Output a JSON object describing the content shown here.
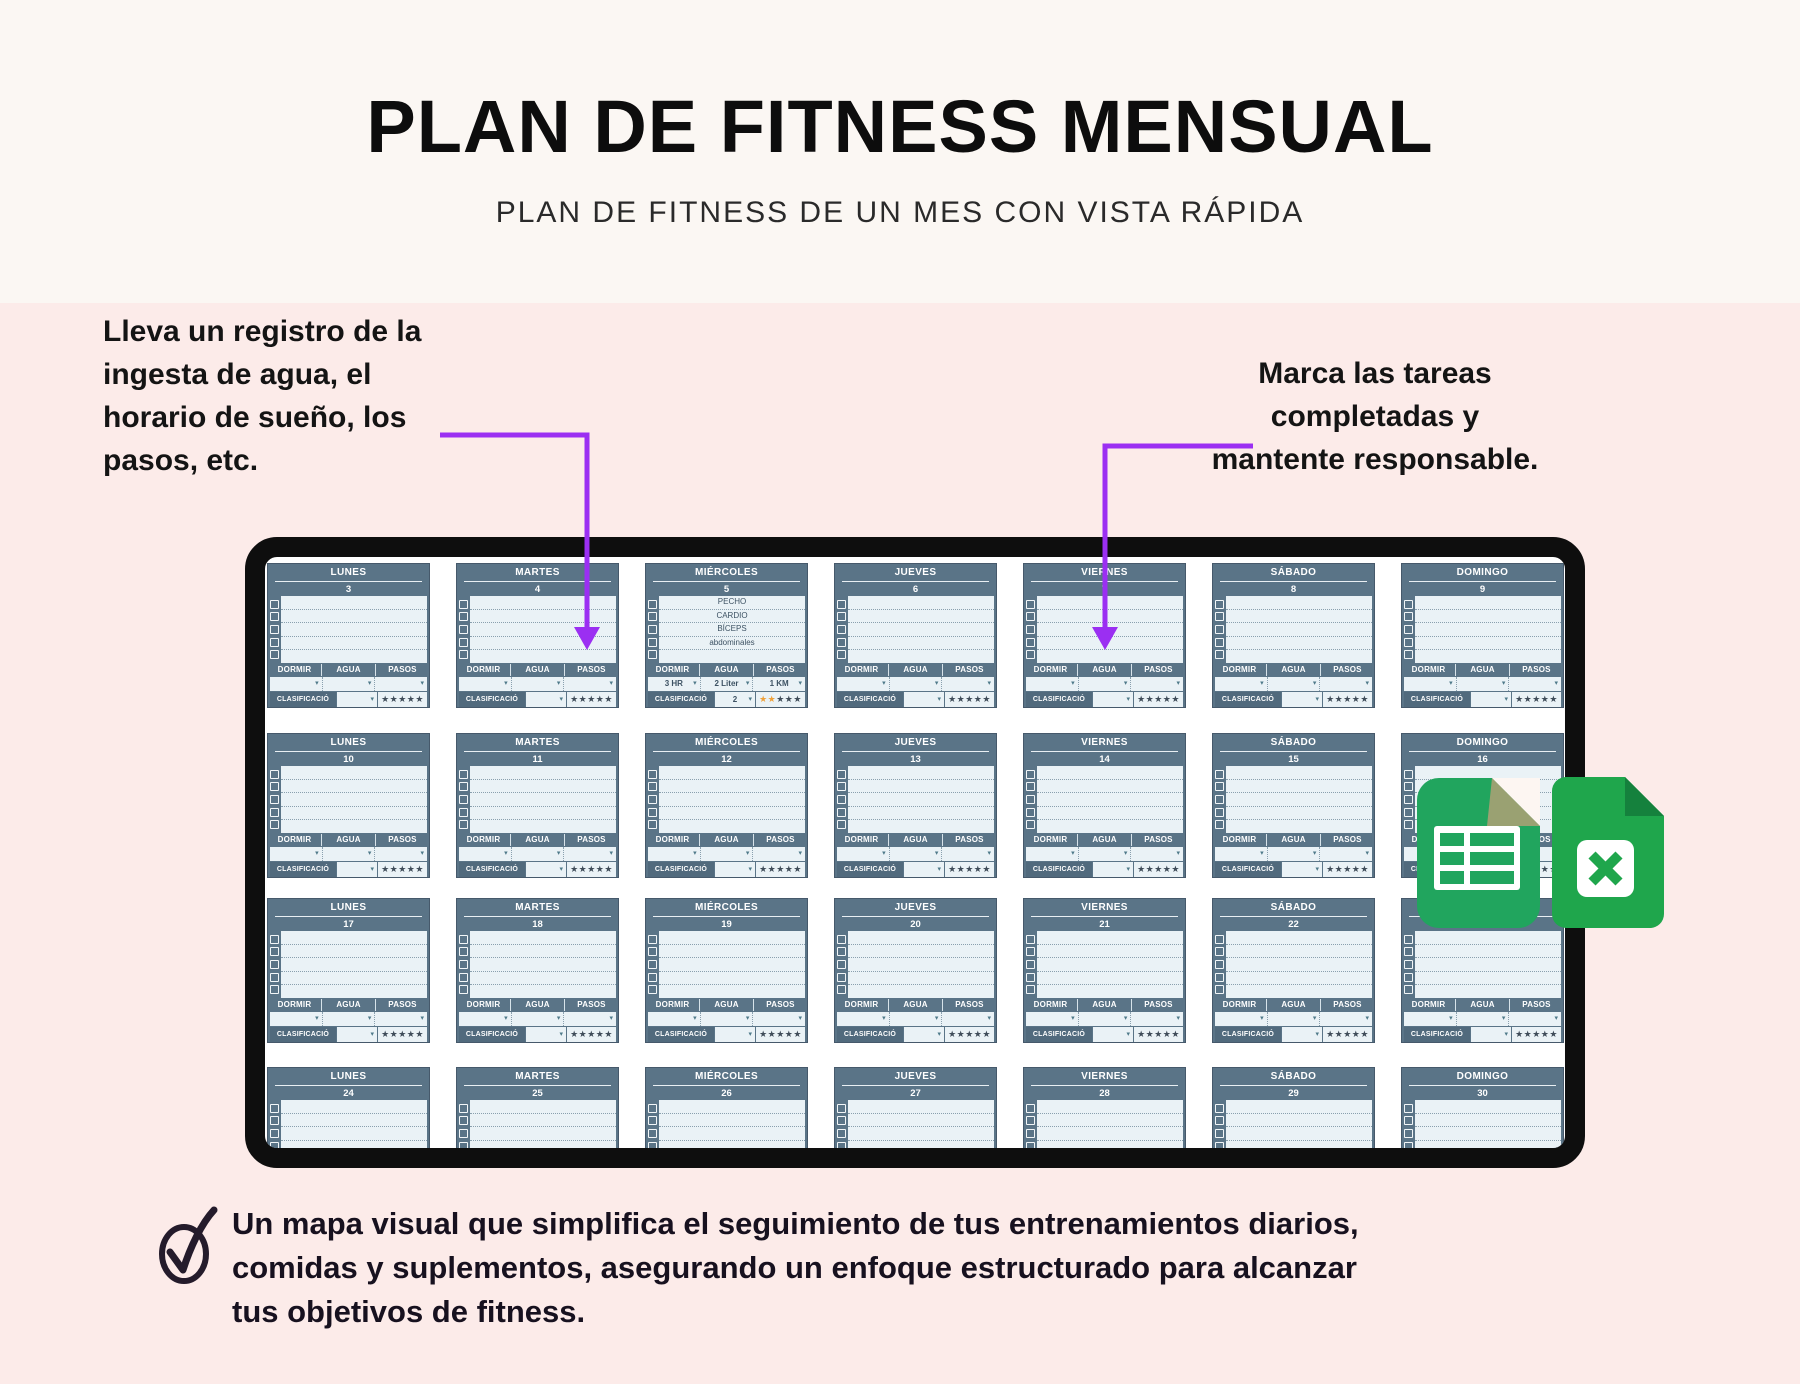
{
  "header": {
    "title": "PLAN DE FITNESS MENSUAL",
    "subtitle": "PLAN DE FITNESS DE UN MES CON VISTA RÁPIDA"
  },
  "annotations": {
    "left": {
      "lines": [
        "Lleva un registro de la",
        "ingesta de agua, el",
        "horario de sueño, los",
        "pasos, etc."
      ]
    },
    "right": {
      "lines": [
        "Marca las tareas",
        "completadas y",
        "mantente responsable."
      ]
    }
  },
  "calendar": {
    "day_headers": [
      "LUNES",
      "MARTES",
      "MIÉRCOLES",
      "JUEVES",
      "VIERNES",
      "SÁBADO",
      "DOMINGO"
    ],
    "labels": {
      "dormir": "DORMIR",
      "agua": "AGUA",
      "pasos": "PASOS",
      "clasificacion": "CLASIFICACIÓ"
    },
    "stars_total": 5,
    "weeks": [
      {
        "days": [
          {
            "num": "3"
          },
          {
            "num": "4"
          },
          {
            "num": "5",
            "tasks": [
              "PECHO",
              "CARDIO",
              "BÍCEPS",
              "abdominales"
            ],
            "dormir": "3 HR",
            "agua": "2 Liter",
            "pasos": "1 KM",
            "rating": "2",
            "stars": 2
          },
          {
            "num": "6"
          },
          {
            "num": "7"
          },
          {
            "num": "8"
          },
          {
            "num": "9"
          }
        ]
      },
      {
        "days": [
          {
            "num": "10"
          },
          {
            "num": "11"
          },
          {
            "num": "12"
          },
          {
            "num": "13"
          },
          {
            "num": "14"
          },
          {
            "num": "15"
          },
          {
            "num": "16"
          }
        ]
      },
      {
        "days": [
          {
            "num": "17"
          },
          {
            "num": "18"
          },
          {
            "num": "19"
          },
          {
            "num": "20"
          },
          {
            "num": "21"
          },
          {
            "num": "22"
          },
          {
            "num": "23"
          }
        ]
      },
      {
        "days": [
          {
            "num": "24"
          },
          {
            "num": "25"
          },
          {
            "num": "26"
          },
          {
            "num": "27"
          },
          {
            "num": "28"
          },
          {
            "num": "29"
          },
          {
            "num": "30"
          }
        ]
      }
    ]
  },
  "icons": {
    "dropdown_glyph": "▾",
    "star_glyph": "★",
    "sheets_icon": "google-sheets",
    "excel_icon": "excel",
    "checkmark_icon": "checkmark"
  },
  "footer": {
    "lines": [
      "Un mapa visual que simplifica el seguimiento de tus entrenamientos diarios,",
      "comidas y suplementos, asegurando un enfoque estructurado para alcanzar",
      "tus objetivos de fitness."
    ]
  },
  "colors": {
    "accent_purple": "#9b2ff2",
    "slate_header": "#5a7487",
    "slate_dark": "#516a7d",
    "cell_light": "#eaf2f6",
    "star_gold": "#efa13a",
    "sheets_green": "#21a55e",
    "excel_green": "#1fa64c",
    "pink_bg": "#fcebe9",
    "top_bg": "#fbf7f3",
    "frame_black": "#0e0e0e"
  }
}
